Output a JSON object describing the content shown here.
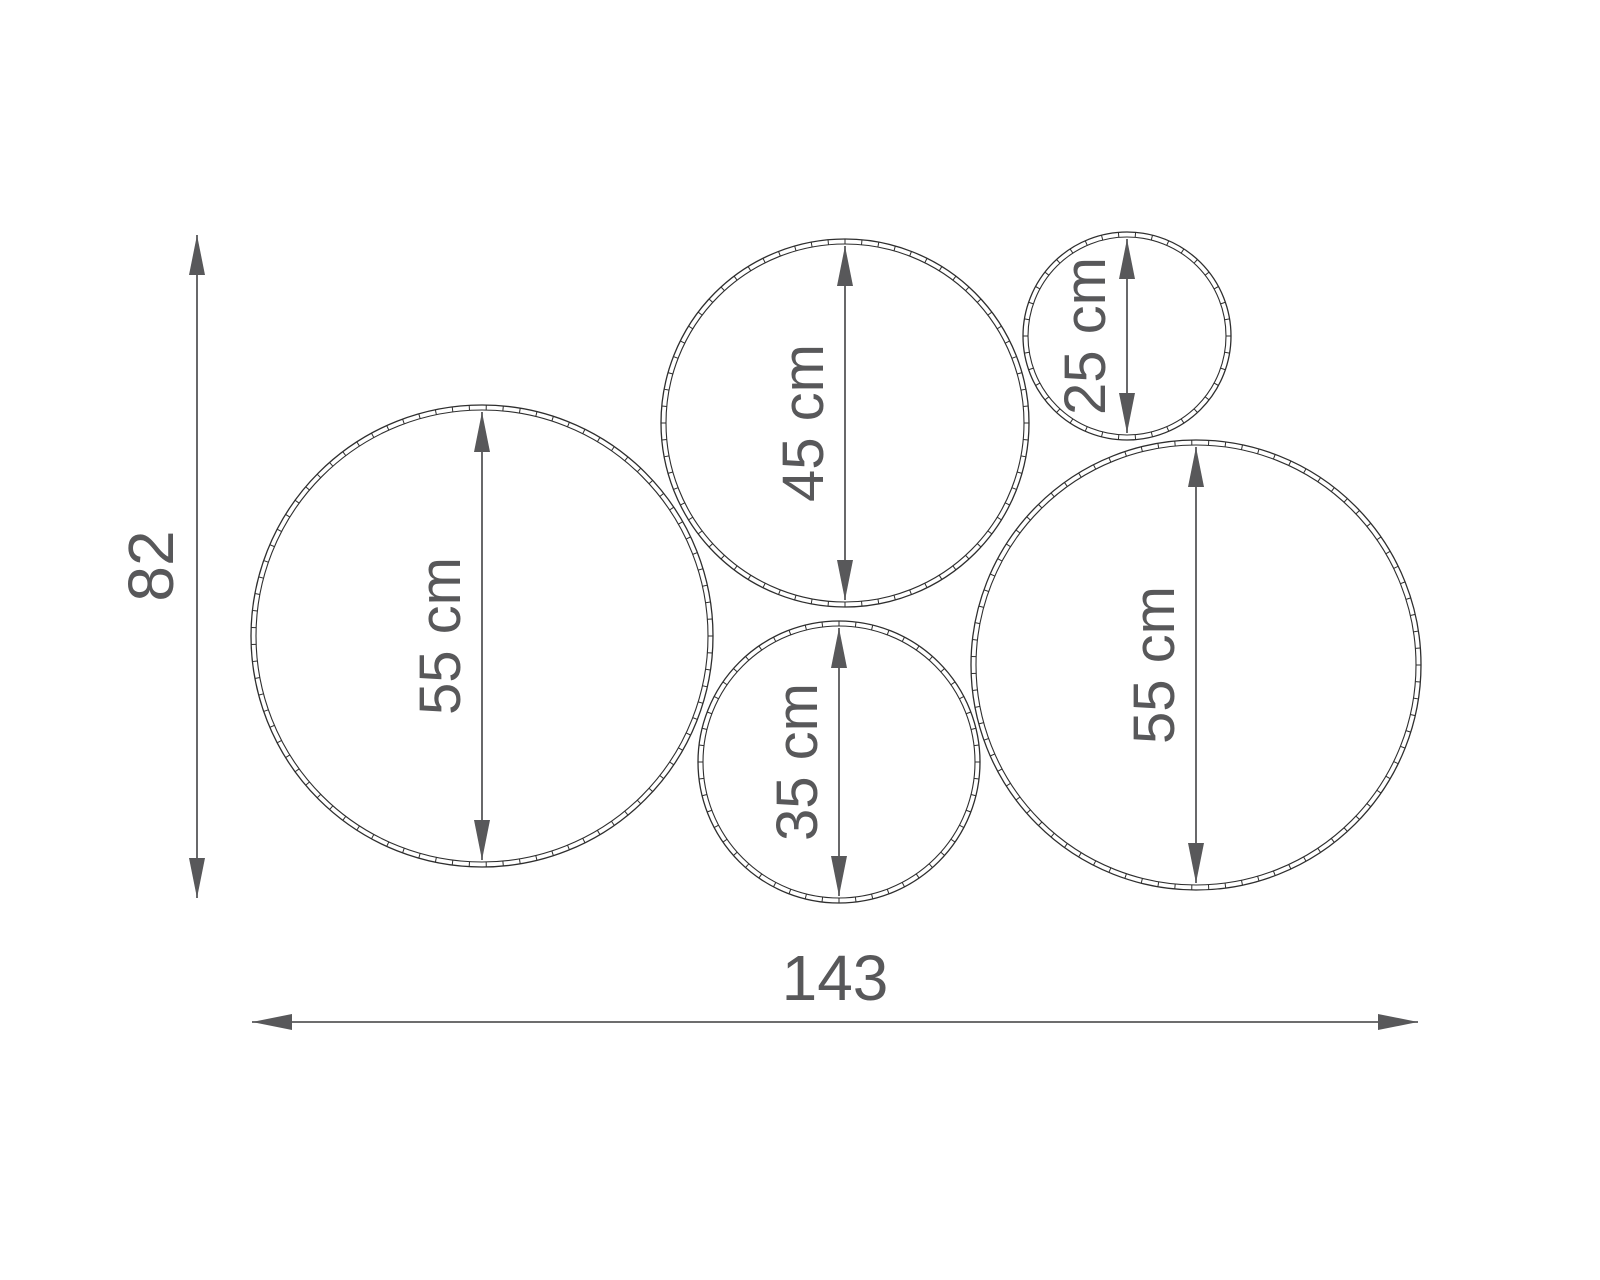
{
  "diagram": {
    "title": "hoop-set-dimension-drawing",
    "background_color": "#ffffff",
    "outline_color": "#2e2e2e",
    "dimension_color": "#58585a",
    "font_size": 58,
    "rim_thickness": 5,
    "tick_arc_spacing": 17,
    "hoops": [
      {
        "id": "hoop-55cm-left",
        "label": "55 cm",
        "cx": 482,
        "cy": 636,
        "r": 231
      },
      {
        "id": "hoop-45cm",
        "label": "45 cm",
        "cx": 845,
        "cy": 423,
        "r": 184
      },
      {
        "id": "hoop-25cm",
        "label": "25 cm",
        "cx": 1127,
        "cy": 336,
        "r": 104
      },
      {
        "id": "hoop-35cm",
        "label": "35 cm",
        "cx": 839,
        "cy": 762,
        "r": 141
      },
      {
        "id": "hoop-55cm-right",
        "label": "55 cm",
        "cx": 1196,
        "cy": 665,
        "r": 225
      }
    ],
    "overall_dimensions": {
      "height": {
        "label": "82",
        "x": 197,
        "y1": 235,
        "y2": 898,
        "text_x": 173,
        "text_y": 566
      },
      "width": {
        "label": "143",
        "y": 1022,
        "x1": 252,
        "x2": 1418,
        "text_x": 835,
        "text_y": 1000
      }
    }
  }
}
